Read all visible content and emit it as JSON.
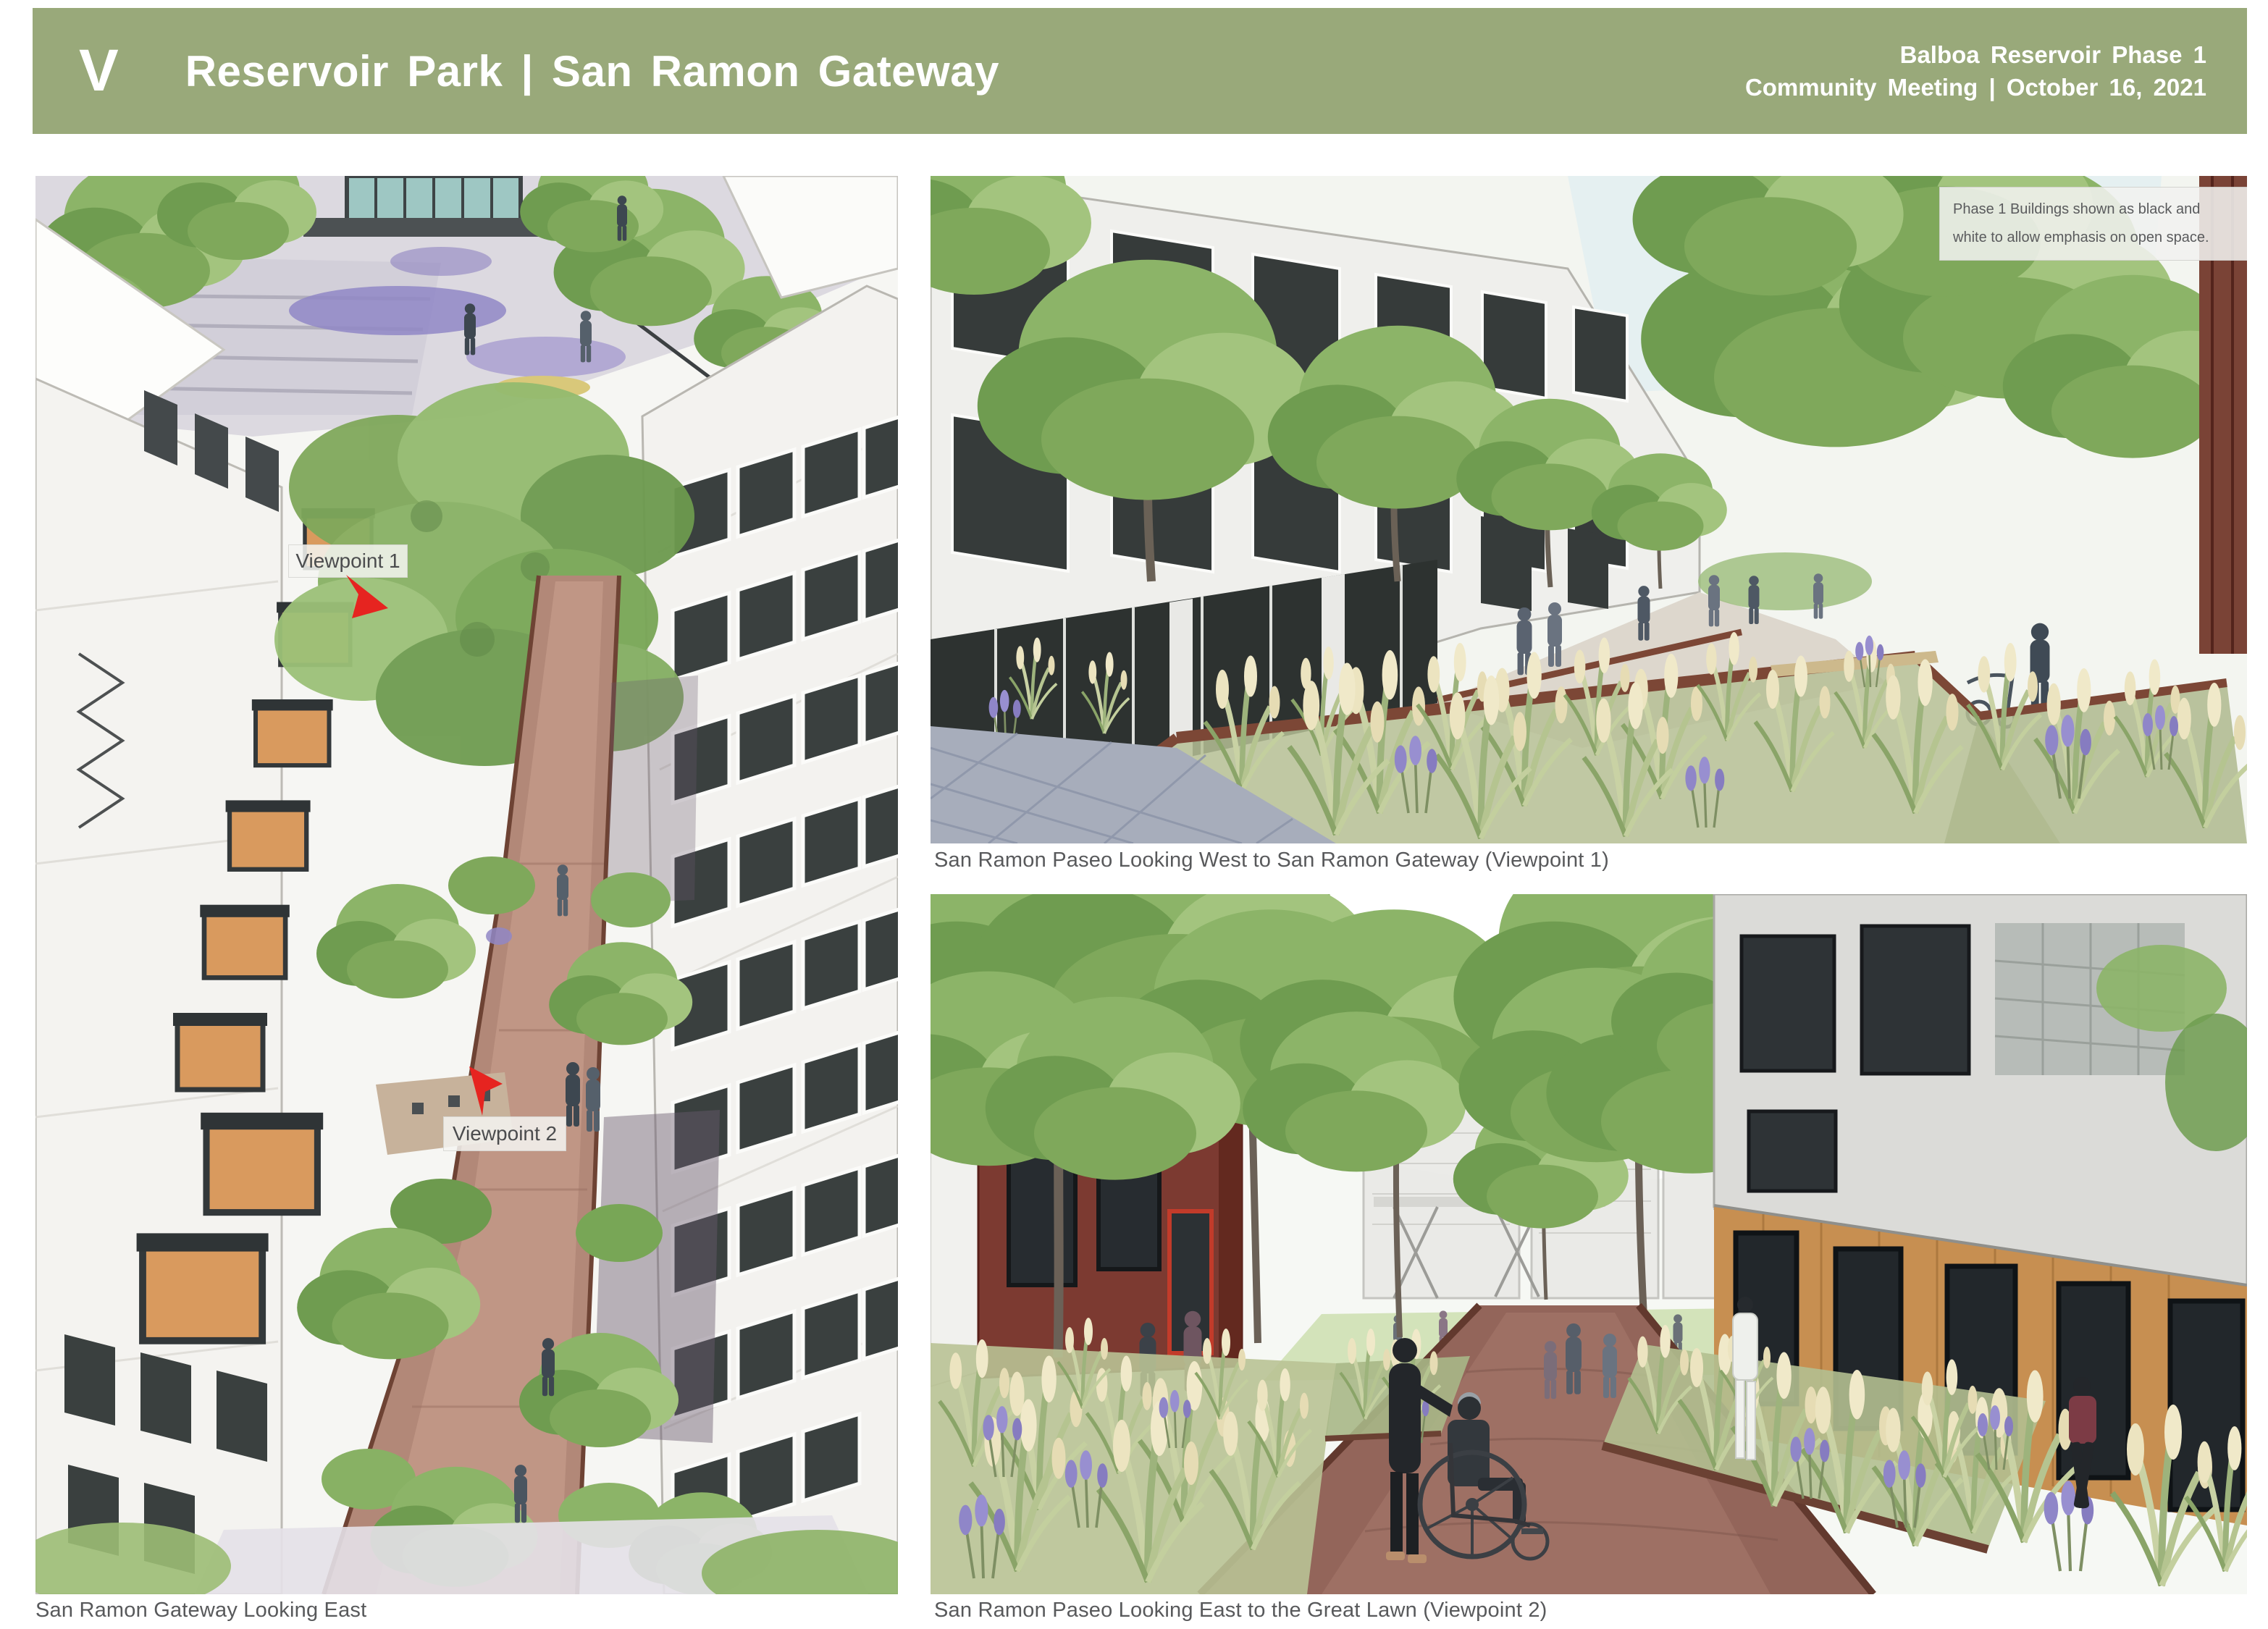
{
  "slide": {
    "header": {
      "logo": "V",
      "title": "Reservoir Park | San Ramon Gateway",
      "event_line1": "Balboa Reservoir Phase 1",
      "event_line2": "Community Meeting | October 16, 2021",
      "bg_color": "#99a97a",
      "text_color": "#ffffff"
    },
    "aerial_panel": {
      "caption": "San Ramon Gateway Looking East",
      "viewpoint1_label": "Viewpoint 1",
      "viewpoint2_label": "Viewpoint 2",
      "arrow_color": "#e62420"
    },
    "viewpoint1_panel": {
      "caption": "San Ramon Paseo Looking West to San Ramon Gateway (Viewpoint 1)",
      "note": "Phase 1 Buildings shown as black and white to allow emphasis on open space."
    },
    "viewpoint2_panel": {
      "caption": "San Ramon Paseo Looking East to the Great Lawn (Viewpoint 2)"
    },
    "colors": {
      "caption_text": "#58595b",
      "corten_steel": "#6e4334",
      "foliage_green": "#84ae62",
      "path_brown": "#b28878",
      "lavender": "#8f86c8"
    }
  }
}
